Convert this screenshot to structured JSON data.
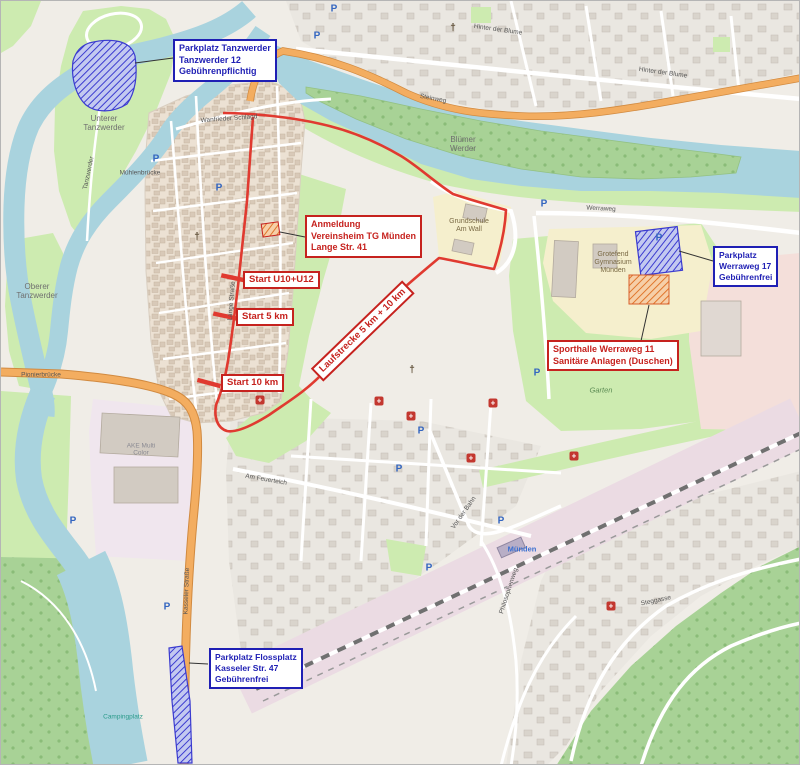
{
  "annotations": {
    "parkplatz_tanzwerder": {
      "line1": "Parkplatz Tanzwerder",
      "line2": "Tanzwerder 12",
      "line3": "Gebührenpflichtig"
    },
    "anmeldung": {
      "line1": "Anmeldung",
      "line2": "Vereinsheim TG Münden",
      "line3": "Lange Str. 41"
    },
    "start_u10_u12": {
      "label": "Start U10+U12"
    },
    "start_5km": {
      "label": "Start 5 km"
    },
    "start_10km": {
      "label": "Start 10 km"
    },
    "laufstrecke": {
      "label": "Laufstrecke 5 km + 10 km"
    },
    "parkplatz_werraweg": {
      "line1": "Parkplatz",
      "line2": "Werraweg 17",
      "line3": "Gebührenfrei"
    },
    "sporthalle": {
      "line1": "Sporthalle Werraweg 11",
      "line2": "Sanitäre Anlagen (Duschen)"
    },
    "parkplatz_flossplatz": {
      "line1": "Parkplatz Flossplatz",
      "line2": "Kasseler Str. 47",
      "line3": "Gebührenfrei"
    }
  },
  "labels": [
    {
      "id": "unterer-tanzwerder",
      "text": "Unterer\nTanzwerder",
      "x": 103,
      "y": 122,
      "rot": 0,
      "cls": "l-place"
    },
    {
      "id": "oberer-tanzwerder",
      "text": "Oberer\nTanzwerder",
      "x": 36,
      "y": 290,
      "rot": 0,
      "cls": "l-place"
    },
    {
      "id": "bluemer-werder",
      "text": "Blümer\nWerder",
      "x": 462,
      "y": 143,
      "rot": 0,
      "cls": "l-place"
    },
    {
      "id": "grotefend-gymnasium",
      "text": "Grotefend\nGymnasium\nMünden",
      "x": 612,
      "y": 262,
      "rot": 0,
      "cls": "l-school"
    },
    {
      "id": "grundschule-am-wall",
      "text": "Grundschule\nAm Wall",
      "x": 468,
      "y": 225,
      "rot": 0,
      "cls": "l-school"
    },
    {
      "id": "garten",
      "text": "Garten",
      "x": 600,
      "y": 390,
      "rot": 0,
      "cls": "l-green"
    },
    {
      "id": "hinter-der-blume-1",
      "text": "Hinter der Blume",
      "x": 497,
      "y": 29,
      "rot": 8,
      "cls": "l-street"
    },
    {
      "id": "hinter-der-blume-2",
      "text": "Hinter der Blume",
      "x": 662,
      "y": 72,
      "rot": 8,
      "cls": "l-street"
    },
    {
      "id": "steinweg",
      "text": "Steinweg",
      "x": 432,
      "y": 98,
      "rot": 11,
      "cls": "l-street"
    },
    {
      "id": "kasseler-strasse",
      "text": "Kasseler Straße",
      "x": 186,
      "y": 590,
      "rot": -88,
      "cls": "l-street"
    },
    {
      "id": "pionierbruecke",
      "text": "Pionierbrücke",
      "x": 40,
      "y": 374,
      "rot": 0,
      "cls": "l-street"
    },
    {
      "id": "muenden-station",
      "text": "Münden",
      "x": 521,
      "y": 549,
      "rot": 0,
      "cls": "l-blue"
    },
    {
      "id": "muehlenbruecke",
      "text": "Mühlenbrücke",
      "x": 139,
      "y": 172,
      "rot": 0,
      "cls": "l-street"
    },
    {
      "id": "werraweg-street",
      "text": "Werraweg",
      "x": 600,
      "y": 208,
      "rot": 3,
      "cls": "l-street"
    },
    {
      "id": "vor-der-bahn",
      "text": "Vor der Bahn",
      "x": 463,
      "y": 512,
      "rot": -55,
      "cls": "l-street"
    },
    {
      "id": "philosophenweg",
      "text": "Philosophenweg",
      "x": 508,
      "y": 590,
      "rot": -72,
      "cls": "l-street"
    },
    {
      "id": "am-feuerteich",
      "text": "Am Feuerteich",
      "x": 265,
      "y": 479,
      "rot": 10,
      "cls": "l-street"
    },
    {
      "id": "lange-strasse",
      "text": "Lange Straße",
      "x": 231,
      "y": 300,
      "rot": -85,
      "cls": "l-street"
    },
    {
      "id": "tanzwerder-street",
      "text": "Tanzwerder",
      "x": 88,
      "y": 172,
      "rot": -78,
      "cls": "l-street"
    },
    {
      "id": "wanfrieder-schlagd",
      "text": "Wanfrieder Schlagd",
      "x": 228,
      "y": 118,
      "rot": -4,
      "cls": "l-street"
    },
    {
      "id": "ake-multi-color",
      "text": "AKE Multi\nColor",
      "x": 140,
      "y": 449,
      "rot": 0,
      "cls": "l-ind"
    },
    {
      "id": "campingplatz",
      "text": "Campingplatz",
      "x": 122,
      "y": 716,
      "rot": 0,
      "cls": "l-camp"
    },
    {
      "id": "steggasse",
      "text": "Steggasse",
      "x": 655,
      "y": 600,
      "rot": -12,
      "cls": "l-street"
    }
  ],
  "markers": [
    {
      "type": "parking",
      "x": 333,
      "y": 8
    },
    {
      "type": "parking",
      "x": 316,
      "y": 35
    },
    {
      "type": "parking",
      "x": 155,
      "y": 158
    },
    {
      "type": "parking",
      "x": 218,
      "y": 187
    },
    {
      "type": "parking",
      "x": 325,
      "y": 245
    },
    {
      "type": "parking",
      "x": 543,
      "y": 203
    },
    {
      "type": "parking",
      "x": 658,
      "y": 237
    },
    {
      "type": "parking",
      "x": 536,
      "y": 372
    },
    {
      "type": "parking",
      "x": 420,
      "y": 430
    },
    {
      "type": "parking",
      "x": 398,
      "y": 468
    },
    {
      "type": "parking",
      "x": 500,
      "y": 520
    },
    {
      "type": "parking",
      "x": 428,
      "y": 567
    },
    {
      "type": "parking",
      "x": 166,
      "y": 606
    },
    {
      "type": "parking",
      "x": 72,
      "y": 520
    },
    {
      "type": "church",
      "x": 196,
      "y": 236
    },
    {
      "type": "church",
      "x": 411,
      "y": 369
    },
    {
      "type": "church",
      "x": 452,
      "y": 27
    },
    {
      "type": "poi",
      "x": 259,
      "y": 399
    },
    {
      "type": "poi",
      "x": 378,
      "y": 400
    },
    {
      "type": "poi",
      "x": 410,
      "y": 415
    },
    {
      "type": "poi",
      "x": 470,
      "y": 457
    },
    {
      "type": "poi",
      "x": 492,
      "y": 402
    },
    {
      "type": "poi",
      "x": 573,
      "y": 455
    },
    {
      "type": "poi",
      "x": 610,
      "y": 605
    }
  ],
  "icon_glyphs": {
    "parking": "P",
    "church": "†",
    "poi": "+"
  },
  "colors": {
    "water": "#a9d3de",
    "grass": "#cdebb0",
    "forest": "#a8d296",
    "school_yellow": "#f5efcd",
    "railway_pink": "#ebdbe3",
    "industrial_pink": "#f0e6ee",
    "residential_pink": "#f4dfda",
    "road_orange": "#f3ad60",
    "route_red": "#e03a30",
    "annotation_red": "#c6221e",
    "annotation_blue": "#1f1fb4",
    "parking_hatch_blue": "#3b3bd0",
    "building_hatch_orange": "#e0762c"
  }
}
